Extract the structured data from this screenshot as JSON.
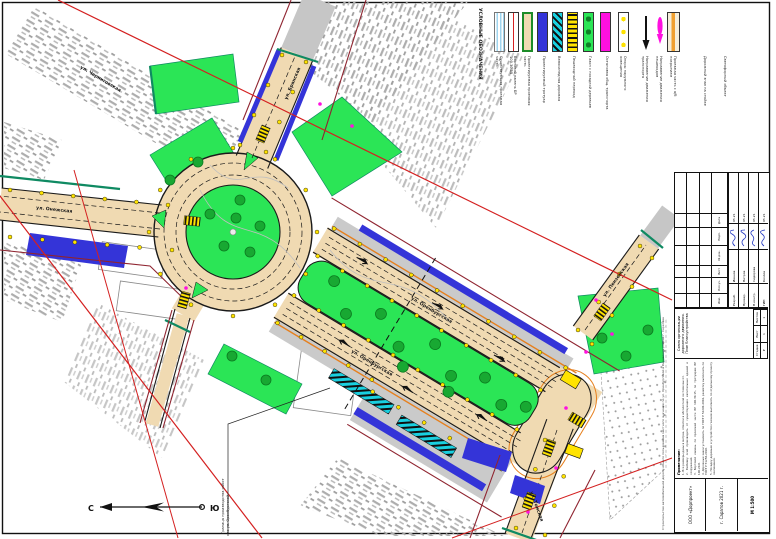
{
  "legend": {
    "title": "УСЛОВНЫЕ ОБОЗНАЧЕНИЯ",
    "items": [
      {
        "label": "Существующая проезжая часть"
      },
      {
        "label": "Бортовой камень БР 100.30.15"
      },
      {
        "label": "Проектируемая проезжая часть"
      },
      {
        "label": "Проектируемый тротуар"
      },
      {
        "label": "Велосипедная дорожка"
      },
      {
        "label": "Пешеходный переход"
      },
      {
        "label": "Газон с посадкой деревьев"
      },
      {
        "label": "Остановка общ. транспорта"
      },
      {
        "label": "Опоры наружного освещения"
      },
      {
        "label": "Направление движения транспорта"
      },
      {
        "label": "Направление движения пешеходов"
      },
      {
        "label": "Проезжая часть с а/б покрытием"
      },
      {
        "label": "Дорожный знак на стойке"
      },
      {
        "label": "Светофорный объект"
      }
    ]
  },
  "streets": {
    "northwest": "ул. Черниговская",
    "north": "ул. Брянская",
    "west": "ул. Онежская",
    "main_upper": "ул. Оренбургская",
    "main_lower": "ул. Оренбургская",
    "northeast": "ул. Пензенская",
    "south": "ул. Томская"
  },
  "north_arrow": {
    "n": "С",
    "s": "Ю"
  },
  "callout": {
    "line1": "Граница производства работ",
    "line2": "по ул. Оренбургской"
  },
  "title_block": {
    "edge_text": "Строительство автомобильной дороги общего пользования местного значения по ул. Оренбургской в Кировском районе г. Саратова",
    "notes_title": "Примечание:",
    "notes": [
      "1. Все размеры даны в метрах, отметки в абсолютной системе высот.",
      "2. Разбивку осей производить от существующих капитальных зданий и сооружений.",
      "3. Бортовой камень по проезжей части БР 100.30.15, по тротуарам БР 100.20.8.",
      "4. Дорожные знаки установить по ГОСТ Р 52290-2004, разметку выполнить по ГОСТ Р 51256-2018.",
      "5. Посадку деревьев и устройство газонов выполнять по отдельному проекту озеленения."
    ],
    "doc_title": "Схема организации дорожного движения.",
    "doc_subtitle": "План благоустройства",
    "scale": "М 1:500",
    "stage_label": "Стадия",
    "stage": "Р",
    "sheet_label": "Лист",
    "sheet": "1",
    "sheets_label": "Листов",
    "sheets": "1",
    "cols": [
      "Изм.",
      "Кол.уч.",
      "Лист",
      "№ док.",
      "Подп.",
      "Дата"
    ],
    "rows": [
      {
        "role": "Разраб.",
        "name": "Иванов",
        "date": "05.21"
      },
      {
        "role": "Провер.",
        "name": "Петров",
        "date": "05.21"
      },
      {
        "role": "Н.контр.",
        "name": "Сидорова",
        "date": "05.21"
      },
      {
        "role": "ГИП",
        "name": "Козлов",
        "date": "05.21"
      }
    ],
    "org": "ООО «Дорпроект»",
    "city_year": "г. Саратов 2021 г."
  }
}
